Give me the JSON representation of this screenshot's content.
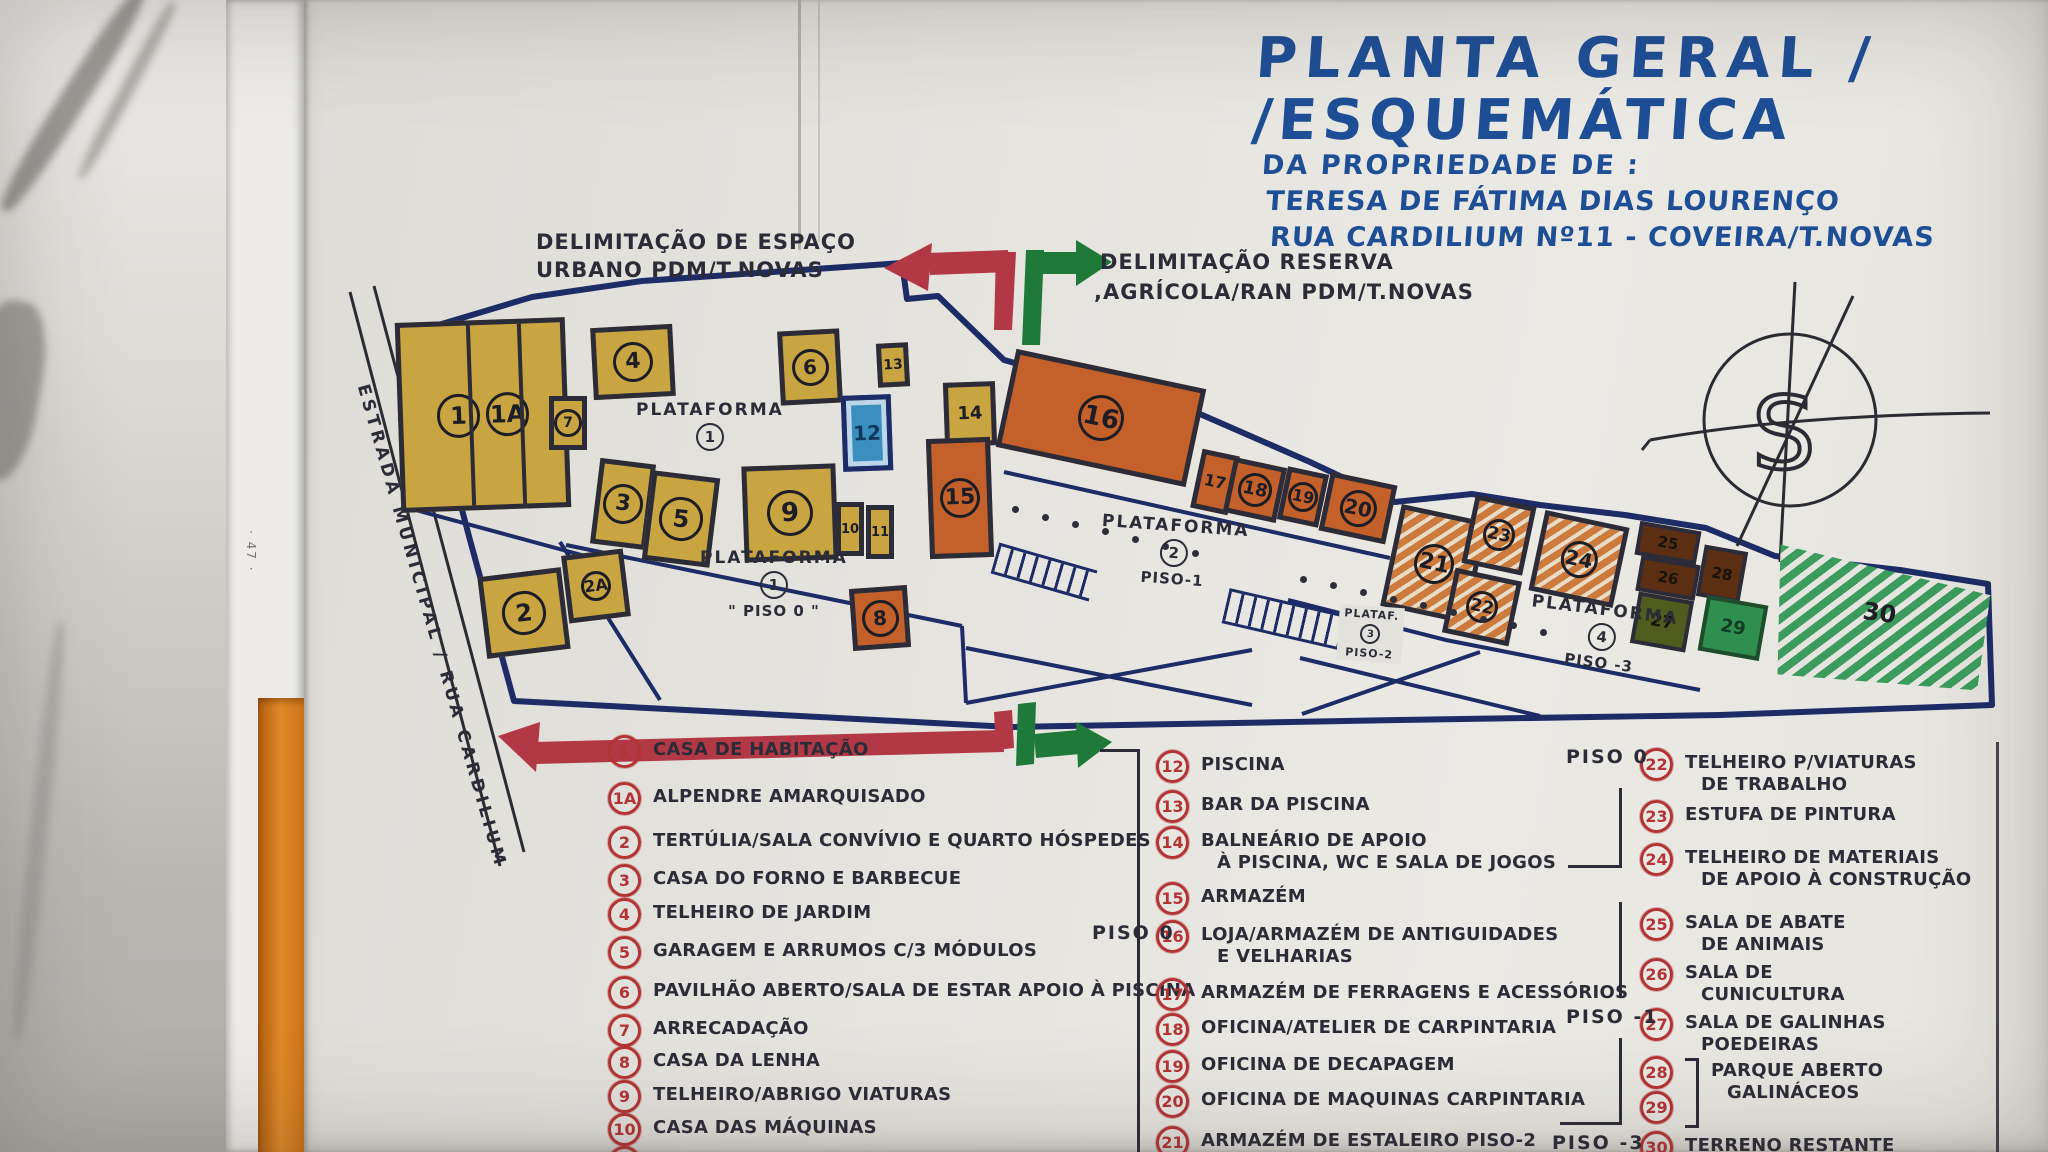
{
  "side_note": "· 47 ·",
  "title": {
    "line1": "PLANTA GERAL /",
    "line2": "/ESQUEMÁTICA",
    "line3": "DA PROPRIEDADE DE :",
    "line4": "TERESA DE FÁTIMA DIAS LOURENÇO",
    "line5": "RUA CARDILIUM Nº11 - COVEIRA/T.NOVAS"
  },
  "labels": {
    "urban_line1": "DELIMITAÇÃO DE ESPAÇO",
    "urban_line2": "URBANO  PDM/T.NOVAS",
    "reserve_line1": "DELIMITAÇÃO RESERVA",
    "reserve_line2": ",AGRÍCOLA/RAN  PDM/T.NOVAS",
    "road": "ESTRADA  MUNICIPAL / RUA CARDILIUM",
    "compass_glyph": "S"
  },
  "colors": {
    "ink": "#2c2c38",
    "navy": "#1d2b66",
    "blue": "#1e4e96",
    "red": "#b23434",
    "mustard": "#c9a542",
    "orange": "#c4602a",
    "orange2": "#cd7a3d",
    "brown": "#5c2f12",
    "olive": "#4f5c1e",
    "grn": "#2e8f4f",
    "grn2": "#3b9c5d",
    "pool": "#3a8fc0",
    "arrow_red": "#b23846",
    "arrow_green": "#1f7a3a"
  },
  "plan": {
    "platform_labels": [
      {
        "name": "PLATAFORMA",
        "num": "1",
        "piso": "",
        "x": 636,
        "y": 400,
        "small": false,
        "rot": 0
      },
      {
        "name": "PLATAFORMA",
        "num": "1",
        "piso": "\" PISO 0 \"",
        "x": 700,
        "y": 548,
        "small": false,
        "rot": 0
      },
      {
        "name": "PLATAFORMA",
        "num": "2",
        "piso": "PISO-1",
        "x": 1100,
        "y": 516,
        "small": false,
        "rot": 4
      },
      {
        "name": "PLATAF.",
        "num": "3",
        "piso": "PISO-2",
        "x": 1338,
        "y": 606,
        "small": true,
        "rot": 4
      },
      {
        "name": "PLATAFORMA",
        "num": "4",
        "piso": "PISO -3",
        "x": 1528,
        "y": 600,
        "small": false,
        "rot": 7
      }
    ],
    "buildings": [
      {
        "id": "1",
        "label2": "1A",
        "x": 398,
        "y": 320,
        "w": 170,
        "h": 190,
        "rot": -2,
        "type": "yellow",
        "circled": true,
        "fs": 24,
        "dividers": [
          0.41,
          0.73
        ]
      },
      {
        "id": "4",
        "x": 592,
        "y": 326,
        "w": 82,
        "h": 72,
        "rot": -3,
        "type": "yellow",
        "circled": true,
        "fs": 22
      },
      {
        "id": "6",
        "x": 779,
        "y": 330,
        "w": 62,
        "h": 74,
        "rot": -3,
        "type": "yellow",
        "circled": true,
        "fs": 20
      },
      {
        "id": "13",
        "x": 877,
        "y": 343,
        "w": 32,
        "h": 44,
        "rot": -3,
        "type": "yellow",
        "circled": false,
        "fs": 14
      },
      {
        "id": "12",
        "x": 842,
        "y": 395,
        "w": 50,
        "h": 76,
        "rot": -2,
        "type": "pool",
        "circled": false,
        "fs": 20
      },
      {
        "id": "7",
        "x": 549,
        "y": 396,
        "w": 38,
        "h": 54,
        "rot": 0,
        "type": "yellow",
        "circled": true,
        "fs": 14
      },
      {
        "id": "3",
        "x": 595,
        "y": 461,
        "w": 56,
        "h": 86,
        "rot": 7,
        "type": "yellow",
        "circled": true,
        "fs": 22
      },
      {
        "id": "5",
        "x": 647,
        "y": 474,
        "w": 68,
        "h": 90,
        "rot": 7,
        "type": "yellow",
        "circled": true,
        "fs": 24
      },
      {
        "id": "2A",
        "x": 565,
        "y": 552,
        "w": 62,
        "h": 68,
        "rot": -7,
        "type": "yellow",
        "circled": true,
        "fs": 16
      },
      {
        "id": "2",
        "x": 482,
        "y": 572,
        "w": 84,
        "h": 82,
        "rot": -7,
        "type": "yellow",
        "circled": true,
        "fs": 24
      },
      {
        "id": "9",
        "x": 743,
        "y": 465,
        "w": 94,
        "h": 96,
        "rot": -2,
        "type": "yellow",
        "circled": true,
        "fs": 26
      },
      {
        "id": "10",
        "x": 836,
        "y": 502,
        "w": 28,
        "h": 54,
        "rot": 0,
        "type": "yellow",
        "circled": false,
        "fs": 13
      },
      {
        "id": "11",
        "x": 866,
        "y": 505,
        "w": 28,
        "h": 54,
        "rot": 0,
        "type": "yellow",
        "circled": false,
        "fs": 13
      },
      {
        "id": "14",
        "x": 944,
        "y": 382,
        "w": 52,
        "h": 64,
        "rot": -2,
        "type": "yellow",
        "circled": false,
        "fs": 18
      },
      {
        "id": "8",
        "x": 851,
        "y": 587,
        "w": 58,
        "h": 62,
        "rot": -4,
        "type": "orange",
        "circled": true,
        "fs": 20
      },
      {
        "id": "15",
        "x": 928,
        "y": 438,
        "w": 64,
        "h": 120,
        "rot": -2,
        "type": "orange",
        "circled": true,
        "fs": 22
      },
      {
        "id": "16",
        "x": 1004,
        "y": 368,
        "w": 194,
        "h": 100,
        "rot": 12,
        "type": "orange",
        "circled": true,
        "fs": 26
      },
      {
        "id": "17",
        "x": 1196,
        "y": 452,
        "w": 38,
        "h": 60,
        "rot": 12,
        "type": "orange",
        "circled": false,
        "fs": 16
      },
      {
        "id": "18",
        "x": 1228,
        "y": 462,
        "w": 54,
        "h": 56,
        "rot": 12,
        "type": "orange",
        "circled": true,
        "fs": 18
      },
      {
        "id": "19",
        "x": 1282,
        "y": 470,
        "w": 42,
        "h": 54,
        "rot": 12,
        "type": "orange",
        "circled": true,
        "fs": 16
      },
      {
        "id": "20",
        "x": 1324,
        "y": 478,
        "w": 68,
        "h": 60,
        "rot": 12,
        "type": "orange",
        "circled": true,
        "fs": 20
      },
      {
        "id": "21",
        "x": 1390,
        "y": 512,
        "w": 88,
        "h": 104,
        "rot": 12,
        "type": "orange_hatch",
        "circled": true,
        "fs": 22
      },
      {
        "id": "23",
        "x": 1468,
        "y": 500,
        "w": 62,
        "h": 70,
        "rot": 12,
        "type": "orange_hatch",
        "circled": true,
        "fs": 17
      },
      {
        "id": "22",
        "x": 1448,
        "y": 574,
        "w": 68,
        "h": 66,
        "rot": 12,
        "type": "orange_hatch",
        "circled": true,
        "fs": 17
      },
      {
        "id": "24",
        "x": 1536,
        "y": 518,
        "w": 86,
        "h": 82,
        "rot": 12,
        "type": "orange_hatch",
        "circled": true,
        "fs": 20
      },
      {
        "id": "25",
        "x": 1637,
        "y": 526,
        "w": 62,
        "h": 34,
        "rot": 10,
        "type": "brown",
        "circled": false,
        "fs": 15
      },
      {
        "id": "26",
        "x": 1638,
        "y": 560,
        "w": 60,
        "h": 36,
        "rot": 10,
        "type": "brown",
        "circled": false,
        "fs": 15
      },
      {
        "id": "28",
        "x": 1700,
        "y": 548,
        "w": 44,
        "h": 52,
        "rot": 10,
        "type": "brown",
        "circled": false,
        "fs": 15
      },
      {
        "id": "27",
        "x": 1634,
        "y": 596,
        "w": 56,
        "h": 52,
        "rot": 10,
        "type": "olive",
        "circled": false,
        "fs": 17
      },
      {
        "id": "29",
        "x": 1702,
        "y": 600,
        "w": 62,
        "h": 56,
        "rot": 10,
        "type": "green",
        "circled": false,
        "fs": 18
      },
      {
        "id": "30",
        "x": 1772,
        "y": 538,
        "w": 215,
        "h": 150,
        "rot": 8,
        "type": "green_hatch",
        "circled": false,
        "fs": 24,
        "wedge": true
      }
    ],
    "dots": [
      [
        1012,
        506
      ],
      [
        1042,
        514
      ],
      [
        1072,
        521
      ],
      [
        1102,
        528
      ],
      [
        1132,
        536
      ],
      [
        1162,
        543
      ],
      [
        1192,
        550
      ],
      [
        1300,
        576
      ],
      [
        1330,
        582
      ],
      [
        1360,
        589
      ],
      [
        1390,
        596
      ],
      [
        1420,
        602
      ],
      [
        1450,
        609
      ],
      [
        1480,
        616
      ],
      [
        1510,
        622
      ],
      [
        1540,
        629
      ]
    ]
  },
  "legend": {
    "piso_markers": [
      {
        "text": "PISO 0",
        "x": 1092,
        "y": 922
      },
      {
        "text": "PISO 0",
        "x": 1566,
        "y": 746
      },
      {
        "text": "PISO -1",
        "x": 1566,
        "y": 1006
      },
      {
        "text": "PISO -3",
        "x": 1552,
        "y": 1132
      }
    ],
    "columns": [
      {
        "x_circle": 608,
        "x_text_gap": 12,
        "entries": [
          {
            "num": "1",
            "y": 735,
            "lines": [
              "CASA DE HABITAÇÃO"
            ]
          },
          {
            "num": "1A",
            "y": 782,
            "lines": [
              "ALPENDRE AMARQUISADO"
            ]
          },
          {
            "num": "2",
            "y": 826,
            "lines": [
              "TERTÚLIA/SALA CONVÍVIO E QUARTO HÓSPEDES"
            ]
          },
          {
            "num": "3",
            "y": 864,
            "lines": [
              "CASA DO FORNO E BARBECUE"
            ]
          },
          {
            "num": "4",
            "y": 898,
            "lines": [
              "TELHEIRO DE JARDIM"
            ]
          },
          {
            "num": "5",
            "y": 936,
            "lines": [
              "GARAGEM E ARRUMOS C/3 MÓDULOS"
            ]
          },
          {
            "num": "6",
            "y": 976,
            "lines": [
              "PAVILHÃO ABERTO/SALA DE ESTAR APOIO À PISCINA"
            ]
          },
          {
            "num": "7",
            "y": 1014,
            "lines": [
              "ARRECADAÇÃO"
            ]
          },
          {
            "num": "8",
            "y": 1046,
            "lines": [
              "CASA DA LENHA"
            ]
          },
          {
            "num": "9",
            "y": 1080,
            "lines": [
              "TELHEIRO/ABRIGO VIATURAS"
            ]
          },
          {
            "num": "10",
            "y": 1113,
            "lines": [
              "CASA DAS MÁQUINAS"
            ]
          },
          {
            "num": "11",
            "y": 1146,
            "lines": []
          }
        ]
      },
      {
        "x_circle": 1156,
        "x_text_gap": 12,
        "entries": [
          {
            "num": "12",
            "y": 750,
            "lines": [
              "PISCINA"
            ]
          },
          {
            "num": "13",
            "y": 790,
            "lines": [
              "BAR DA PISCINA"
            ]
          },
          {
            "num": "14",
            "y": 826,
            "lines": [
              "BALNEÁRIO DE APOIO",
              "À PISCINA, WC E SALA DE JOGOS"
            ]
          },
          {
            "num": "15",
            "y": 882,
            "lines": [
              "ARMAZÉM"
            ]
          },
          {
            "num": "16",
            "y": 920,
            "lines": [
              "LOJA/ARMAZÉM DE ANTIGUIDADES",
              "E VELHARIAS"
            ]
          },
          {
            "num": "17",
            "y": 978,
            "lines": [
              "ARMAZÉM DE FERRAGENS E ACESSÓRIOS"
            ]
          },
          {
            "num": "18",
            "y": 1013,
            "lines": [
              "OFICINA/ATELIER DE CARPINTARIA"
            ]
          },
          {
            "num": "19",
            "y": 1050,
            "lines": [
              "OFICINA DE DECAPAGEM"
            ]
          },
          {
            "num": "20",
            "y": 1085,
            "lines": [
              "OFICINA DE MAQUINAS CARPINTARIA"
            ]
          },
          {
            "num": "21",
            "y": 1126,
            "lines": [
              "ARMAZÉM DE ESTALEIRO PISO-2"
            ]
          }
        ]
      },
      {
        "x_circle": 1640,
        "x_text_gap": 12,
        "entries": [
          {
            "num": "22",
            "y": 748,
            "lines": [
              "TELHEIRO P/VIATURAS",
              "DE TRABALHO"
            ]
          },
          {
            "num": "23",
            "y": 800,
            "lines": [
              "ESTUFA DE PINTURA"
            ]
          },
          {
            "num": "24",
            "y": 843,
            "lines": [
              "TELHEIRO DE MATERIAIS",
              "DE APOIO À CONSTRUÇÃO"
            ]
          },
          {
            "num": "25",
            "y": 908,
            "lines": [
              "SALA DE ABATE",
              "DE ANIMAIS"
            ]
          },
          {
            "num": "26",
            "y": 958,
            "lines": [
              "SALA DE",
              "CUNICULTURA"
            ]
          },
          {
            "num": "27",
            "y": 1008,
            "lines": [
              "SALA DE GALINHAS",
              "POEDEIRAS"
            ]
          },
          {
            "nums": [
              "28",
              "29"
            ],
            "y": 1056,
            "lines": [
              "PARQUE ABERTO",
              "GALINÁCEOS"
            ]
          },
          {
            "num": "30",
            "y": 1131,
            "lines": [
              "TERRENO RESTANTE"
            ]
          }
        ]
      }
    ]
  }
}
